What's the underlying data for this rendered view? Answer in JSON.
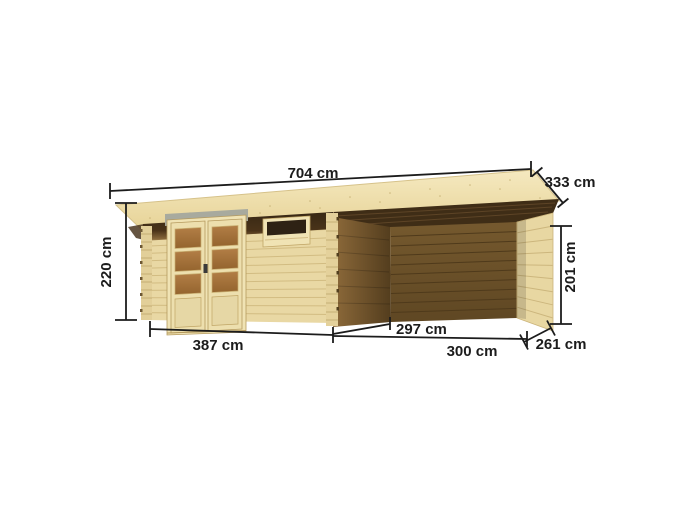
{
  "figure": {
    "subject": "wooden flat-roof garden shed with attached open side canopy, shown in perspective with measurement annotations"
  },
  "labels": {
    "roof_width": "704 cm",
    "roof_depth": "333 cm",
    "wall_height_left": "220 cm",
    "canopy_height_right": "201 cm",
    "shed_base_width": "387 cm",
    "canopy_inner_depth": "297 cm",
    "canopy_base_width": "300 cm",
    "canopy_base_depth": "261 cm"
  },
  "colors": {
    "background": "#ffffff",
    "roof_wood": "#f0e2b0",
    "wall_wood": "#e9d8a4",
    "shadow_wood": "#44311a",
    "interior_back_wall": "#6b5129",
    "interior_side_wall": "#7a5b30",
    "canopy_right_wall": "#e8d7a2",
    "door_frame": "#f0e3b4",
    "glass_pane": "#a7743e",
    "lintel_gray": "#a8aa9e",
    "dimension_line": "#1c1c1c"
  }
}
